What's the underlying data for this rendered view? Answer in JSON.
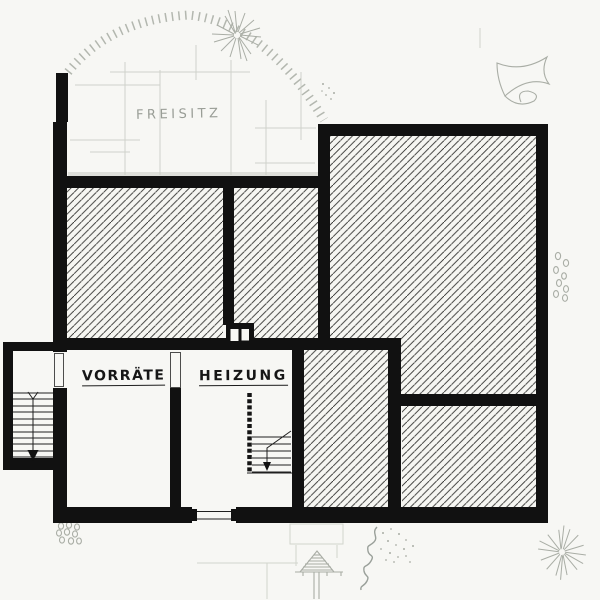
{
  "plan": {
    "room_labels": [
      {
        "id": "freisitz",
        "text": "FREISITZ"
      },
      {
        "id": "vorraete",
        "text": "VORRÄTE"
      },
      {
        "id": "heizung",
        "text": "HEIZUNG"
      }
    ]
  },
  "colors": {
    "wall": "#111111",
    "paper": "#f7f7f4",
    "sketch": "#a9ada5",
    "label_gray": "#999d96",
    "label_dark": "#161616",
    "hatch_line": "#30302e"
  }
}
